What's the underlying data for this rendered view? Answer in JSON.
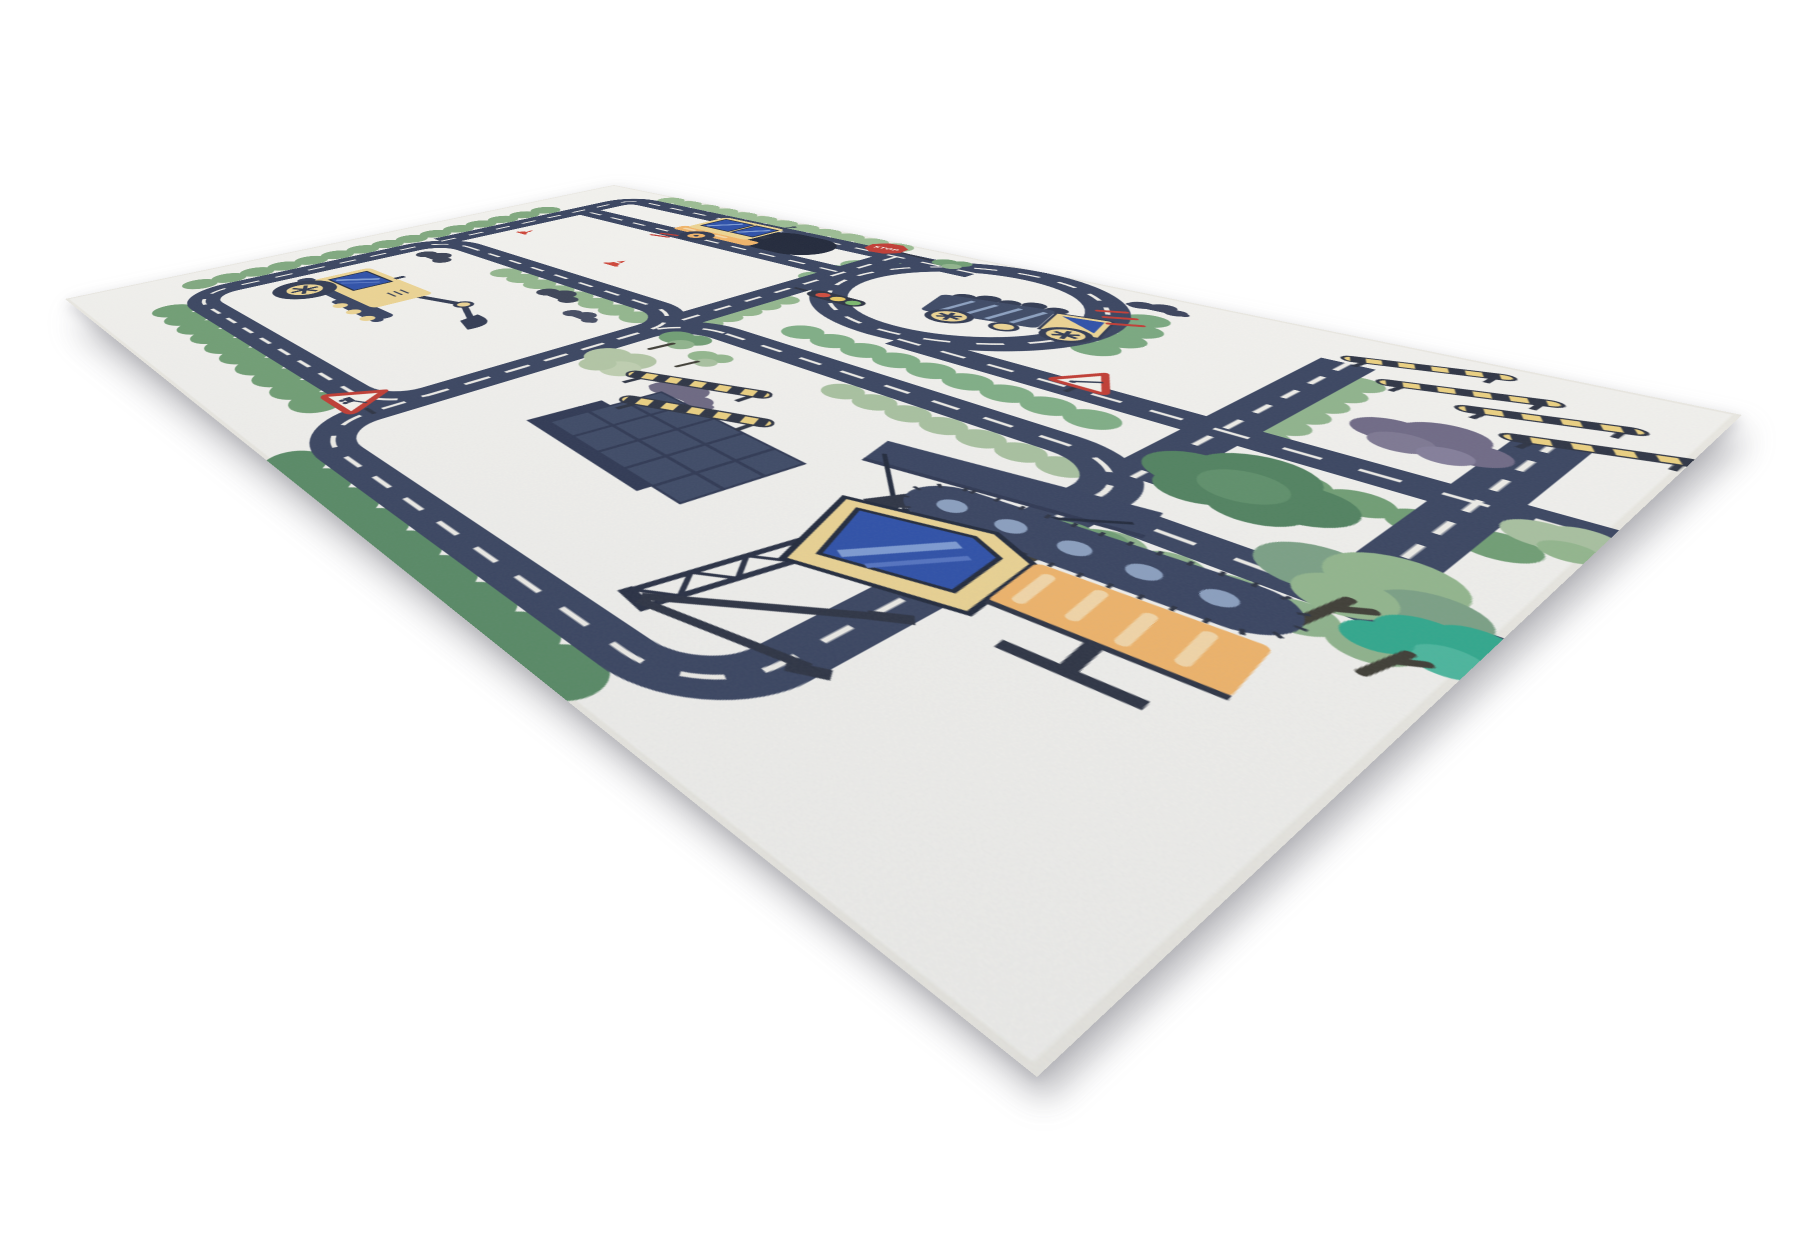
{
  "scene": {
    "type": "product photo",
    "subject": "children's road traffic play rug with construction vehicles, viewed at an angle",
    "page_background": "#ffffff"
  },
  "rug": {
    "base_color": "#f4f3ef",
    "edge_color": "#eceae3",
    "shadow_color": "rgba(125,125,132,0.42)",
    "stop_sign_label": "STOP",
    "palette": {
      "road_navy": "#37425e",
      "lane_dash": "#f1efe9",
      "dark_navy": "#2a3040",
      "vehicle_yellow": "#eed592",
      "vehicle_orange": "#f3b568",
      "window_blue": "#2b4ea8",
      "window_stripe": "#7d9bd4",
      "signal_red": "#c23a32",
      "green_light": "#9cbd93",
      "green_mid": "#6f9e72",
      "green_dark": "#4f815d",
      "green_sage": "#b3c7a4",
      "teal_tree": "#2ea98c",
      "purple_bush": "#6e6884"
    },
    "traffic_light": {
      "red": "#d04a3a",
      "amber": "#e8c860",
      "green": "#7ab86a"
    },
    "elements": [
      "road network with white dashed lane markings",
      "top-left road loop",
      "central road loop",
      "roundabout",
      "excavator",
      "road roller",
      "dump truck",
      "crawler crane with lattice boom and hanging panel",
      "construction building",
      "yellow-black striped barriers",
      "stop sign",
      "traffic light",
      "warning triangle signs",
      "traffic cones",
      "green trees and bushes",
      "teal tree",
      "purple bushes",
      "dark smoke clouds",
      "red signal marks"
    ],
    "visible_text": [
      "STOP"
    ]
  }
}
